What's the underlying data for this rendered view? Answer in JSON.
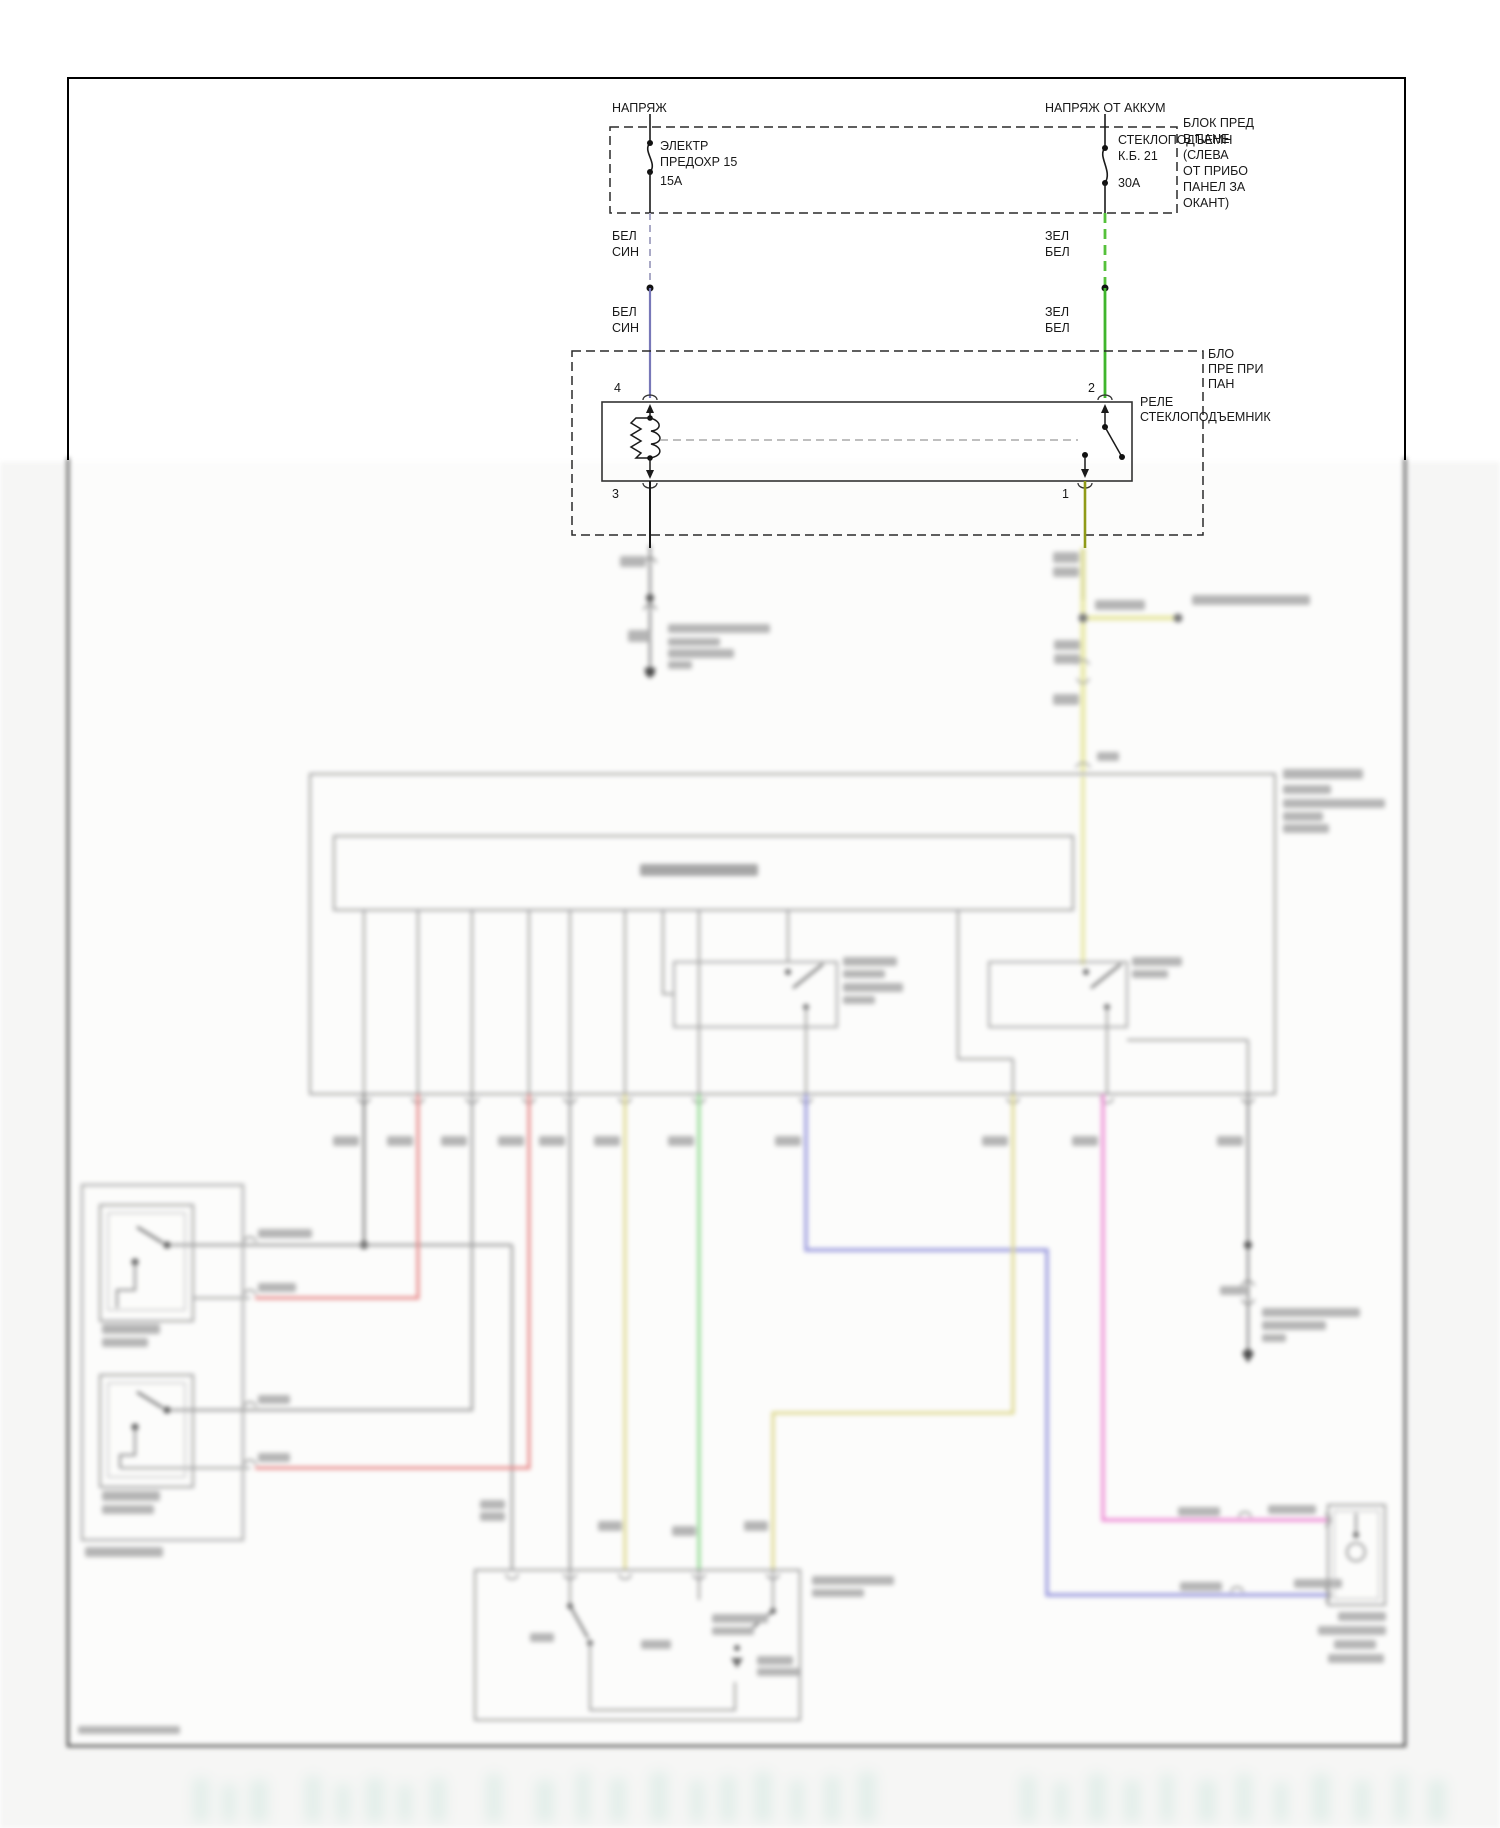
{
  "diagram": {
    "feeds": {
      "left": "НАПРЯЖ",
      "right": "НАПРЯЖ ОТ АККУМ"
    },
    "fuses": {
      "left": {
        "name1": "ЭЛЕКТР",
        "name2": "ПРЕДОХР 15",
        "rating": "15А"
      },
      "right": {
        "name": "СТЕКЛОПОДЪЕМН",
        "circuit": "К.Б. 21",
        "rating": "30А"
      }
    },
    "fuse_panel_note": [
      "БЛОК ПРЕД",
      "В ПАНЕ",
      "(СЛЕВА",
      "ОТ ПРИБО",
      "ПАНЕЛ ЗА",
      "ОКАНТ)"
    ],
    "relay_panel_note": [
      "БЛО",
      "ПРЕ ПРИ",
      "ПАН"
    ],
    "relay": {
      "name1": "РЕЛЕ",
      "name2": "СТЕКЛОПОДЪЕМНИК",
      "pins": {
        "coil_top": "4",
        "coil_bottom": "3",
        "switch_top": "2",
        "switch_bottom": "1"
      }
    },
    "wires": {
      "left_label": [
        "БЕЛ",
        "СИН"
      ],
      "right_label": [
        "ЗЕЛ",
        "БЕЛ"
      ]
    }
  },
  "colors": {
    "wire_white_blue": "#7878b8",
    "wire_green_white": "#3fb52c",
    "wire_green_dashed": "#55c13a",
    "wire_yellow_olive": "#8f9a18",
    "wire_yellow_pale": "#e9e9a8",
    "wire_red": "#e88a8a",
    "wire_khaki": "#ddd88e",
    "wire_green_pale": "#8fd98f",
    "wire_purple": "#9b9bde",
    "wire_pink": "#ee8ed6",
    "wire_gray": "#9c9c9c",
    "wire_dark": "#787878"
  }
}
